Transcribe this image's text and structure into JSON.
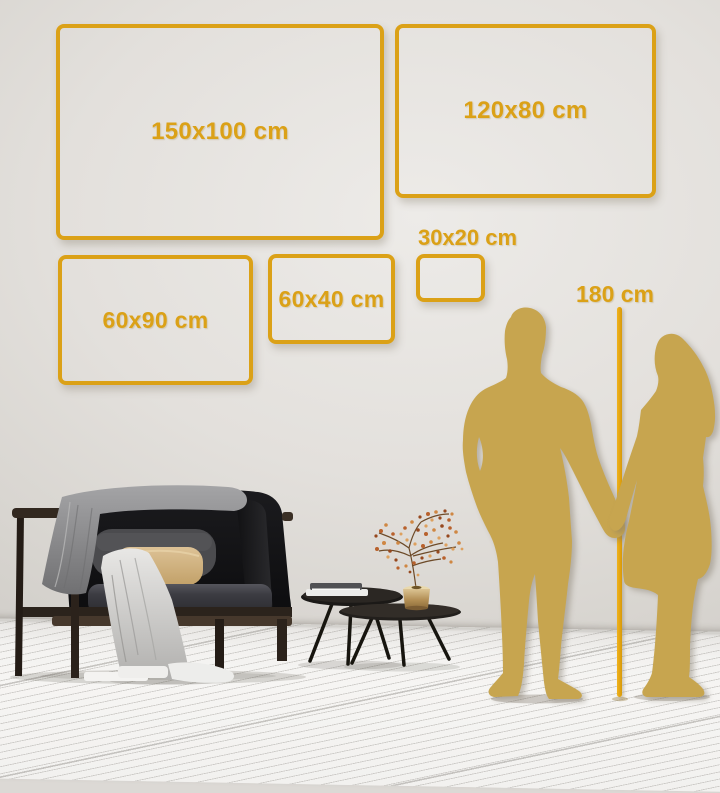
{
  "sizes": {
    "items": [
      {
        "label": "150x100 cm",
        "width_cm": 150,
        "height_cm": 100
      },
      {
        "label": "120x80 cm",
        "width_cm": 120,
        "height_cm": 80
      },
      {
        "label": "60x90 cm",
        "width_cm": 60,
        "height_cm": 90
      },
      {
        "label": "60x40 cm",
        "width_cm": 60,
        "height_cm": 40
      },
      {
        "label": "30x20 cm",
        "width_cm": 30,
        "height_cm": 20
      }
    ]
  },
  "ruler": {
    "label": "180 cm",
    "height_cm": 180
  },
  "icons": [
    "man-silhouette",
    "woman-silhouette",
    "sofa",
    "throw-blanket",
    "coffee-tables",
    "vase-with-plant",
    "height-pole"
  ],
  "colors": {
    "accent_gold": "#DBA117",
    "pole_gold": "#E5A50C",
    "silhouette_gold": "#C7A54F",
    "wall": "#DCD9D5",
    "floor": "#F5F4F2"
  }
}
